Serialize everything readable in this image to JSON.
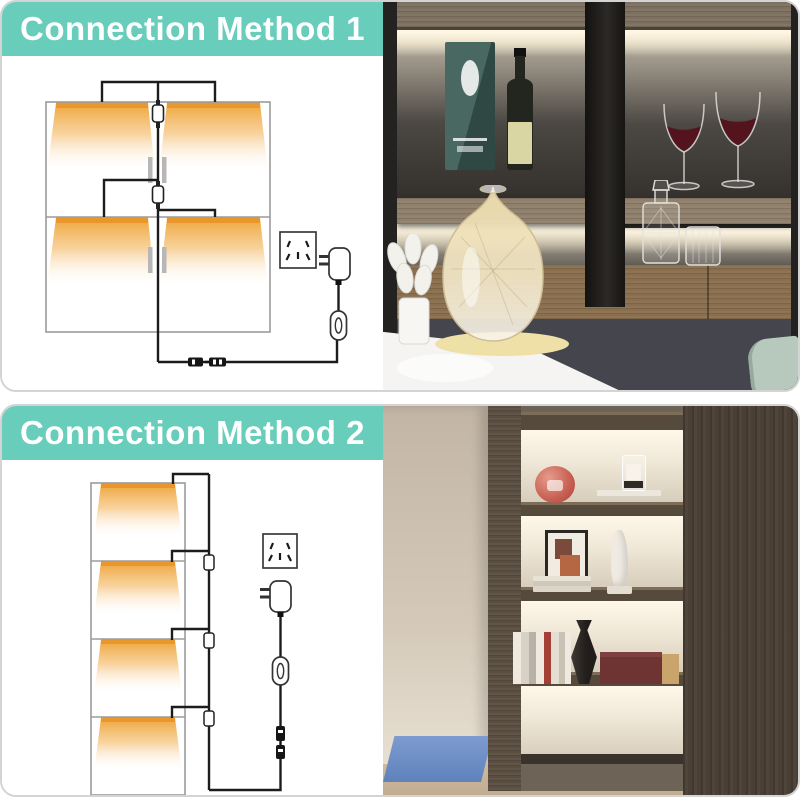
{
  "theme": {
    "page_bg": "#ffffff",
    "banner_bg": "#68cdbb",
    "banner_text": "#ffffff",
    "card_border": "#d4d4d4",
    "wire_color": "#1c1c1c",
    "outline_color": "#9b9b9b",
    "glow_orange": "#eda02f"
  },
  "cards": [
    {
      "title": "Connection Method 1",
      "diagram_components": [
        "cabinet-2x2-grid",
        "light-panel x4",
        "power-outlet",
        "power-adapter",
        "inline-switch",
        "dc-connector-pair"
      ],
      "photo_description": "Dark display cabinet with warm under-shelf lighting: whisky gift box and bottle, two red-wine glasses, large glass vase, crystal decanter and tumbler, white table with tulips"
    },
    {
      "title": "Connection Method 2",
      "diagram_components": [
        "shelf-stack-4",
        "light-panel x4",
        "power-outlet",
        "power-adapter",
        "inline-switch",
        "dc-connector-pair"
      ],
      "photo_description": "Modern bookshelf niche with white under-shelf lighting: coral sphere, candle on book, framed abstract art, white sculpture, books, dark vase, burgundy box, blue rug on wood floor"
    }
  ]
}
